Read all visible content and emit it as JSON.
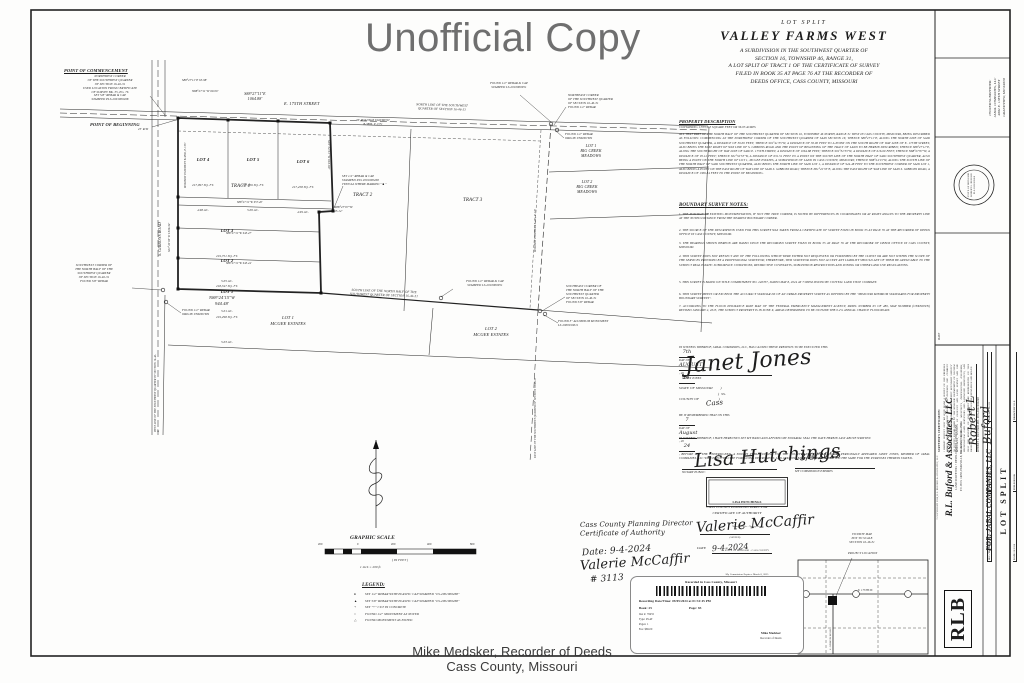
{
  "watermark": "Unofficial Copy",
  "footer": {
    "recorder": "Mike Medsker, Recorder of Deeds",
    "county": "Cass County, Missouri"
  },
  "title": {
    "kicker": "LOT  SPLIT",
    "name": "VALLEY  FARMS  WEST",
    "lines": "A  SUBDIVISION  IN  THE  SOUTHWEST  QUARTER  OF\nSECTION  16,  TOWNSHIP  46,  RANGE  31,\nA  LOT  SPLIT  OF  TRACT  1  OF  THE  CERTIFICATE  OF  SURVEY\nFILED  IN  BOOK  35  AT  PAGE  76  AT  THE  RECORDER  OF\nDEEDS  OFFICE,  CASS  COUNTY,  MISSOURI"
  },
  "description": {
    "heading": "PROPERTY  DESCRIPTION",
    "containing": "CONTAINING 1,553,113 SQUARE FEET OR 36.05 ACRES",
    "body": "ALL THAT PART OF THE NORTH HALF OF THE SOUTHWEST QUARTER OF SECTION 16, TOWNSHIP 46 NORTH, RANGE 31 WEST IN CASS COUNTY, MISSOURI, BEING DESCRIBED AS FOLLOWS: COMMENCING AT THE NORTHWEST CORNER OF THE SOUTHWEST QUARTER OF SAID SECTION 16; THENCE S88°27'11\"E, ALONG THE NORTH LINE OF SAID SOUTHWEST QUARTER, A DISTANCE OF 30.00 FEET; THENCE S01°41'35\"W, A DISTANCE OF 30.00 FEET TO A POINT ON THE SOUTH RIGHT OF WAY LINE OF E. 175TH STREET, ALSO BEING THE EAST RIGHT OF WAY LINE OF S. GIBBONS ROAD AND THE POINT OF BEGINNING OF THE TRACT OF LAND TO BE HEREIN DESCRIBED; THENCE S88°27'11\"E, ALONG THE SOUTH RIGHT OF WAY LINE OF SAID E. 175TH STREET, A DISTANCE OF 1064.88 FEET; THENCE S01°32'53\"W, A DISTANCE OF 616.60 FEET; THENCE N88°27'07\"W, A DISTANCE OF 95.12 FEET; THENCE S01°32'53\"W, A DISTANCE OF 631.51 FEET TO A POINT ON THE SOUTH LINE OF THE NORTH HALF OF SAID SOUTHWEST QUARTER, ALSO BEING A POINT ON THE NORTH LINE OF LOT 1, MCGEE ESTATES, A SUBDIVISION OF LAND IN CASS COUNTY, MISSOURI; THENCE N88°24'15\"W, ALONG THE SOUTH LINE OF THE NORTH HALF OF SAID SOUTHWEST QUARTER, ALSO BEING THE NORTH LINE OF SAID LOT 1, A DISTANCE OF 944.48 FEET TO THE SOUTHWEST CORNER OF SAID LOT 1, ALSO BEING A POINT ON THE EAST RIGHT OF WAY LINE OF SAID S. GIBBONS ROAD; THENCE N01°41'35\"E, ALONG THE EAST RIGHT OF WAY LINE OF SAID S. GIBBONS ROAD, A DISTANCE OF 1306.34 FEET TO THE POINT OF BEGINNING."
  },
  "notes": {
    "heading": "BOUNDARY  SURVEY  NOTES:",
    "items": [
      "1.   THE POSITION OF EXISTING MONUMENTATION, IF NOT THE TRUE CORNER, IS NOTED BY DIFFERENCES IN COORDINATES OR AT RIGHT ANGLES TO THE PROPERTY LINE AT THE NOTED DISTANCE FROM THE NEAREST BOUNDARY CORNER.",
      "2.   THE SOURCE OF THE DESCRIPTION USED FOR THIS SURVEY WAS TAKEN FROM A CERTIFICATE OF SURVEY FILED IN BOOK 35 AT PAGE 76 AT THE RECORDER OF DEEDS OFFICE IN CASS COUNTY, MISSOURI.",
      "3.   THE BEARINGS SHOWN HEREON ARE BASED UPON THE RECORDED SURVEY FILED IN BOOK 35 AT PAGE 76 AT THE RECORDER OF DEEDS OFFICE IN CASS COUNTY, MISSOURI.",
      "4.   THIS SURVEY DOES NOT REFLECT ANY OF THE FOLLOWING WHICH WERE EITHER NOT REQUESTED OR FURNISHED BY THE CLIENT OR ARE NOT WITHIN THE SCOPE OF THE SERVICES PROVIDED BY A PROFESSIONAL SURVEYOR; THEREFORE, THIS SURVEYOR DOES NOT ACCEPT ANY LIABILITY SHOULD ANY OF THEM BE APPLICABLE TO THE SUBJECT REAL ESTATE: SUBSURFACE CONDITIONS, RESTRICTIVE COVENANTS, SUBDIVISION RESTRICTIONS AND ZONING OR OTHER LAND USE REGULATIONS.",
      "5.   THIS SURVEY IS BASED ON TITLE COMMITMENT NO. 240707, DATED MAY 8, 2024 AT 7:00PM ISSUED BY COTTELL LAND TITLE COMPANY.",
      "6.   THIS SURVEY MEETS OR EXCEEDS THE ACCURACY STANDAR DS OF AN URBAN PROPERTY SURVEY AS DEFINED BY THE \"MISSOURI MINIMUM STANDARDS FOR PROPERTY BOUNDARY SURVEYS\".",
      "7.   ACCORDING TO THE FLOOD INSURANCE RATE MAP OF THE FEDERAL EMERGENCY MANAGEMENT AGENCY, PANEL NUMBER 65 OF 480, MAP NUMBER (UNKNOWN) REVISED JANUARY 2, 2013, THE SUBJECT PROPERTY IS IN ZONE X, AREAS DETERMINED TO BE OUTSIDE THE 0.2% ANNUAL CHANCE FLOODPLAIN."
    ]
  },
  "execution": {
    "pre": "IN WITNESS WHEREOF, JABAL COMPANIES, LLC, HAS CAUSED THESE PRESENTS TO BE EXECUTED THIS",
    "day": "7th",
    "mid": "DAY OF",
    "month": "AUGUST",
    "end": ", 20",
    "year": "24.",
    "sig": "Janet Jones",
    "name": "JANET JONES"
  },
  "state_block": {
    "lines": "STATE OF MISSOURI        )\n                                        )  SS.\nCOUNTY OF                    )",
    "county": "Cass"
  },
  "ack": {
    "pre": "BE IT REMEMBERED THAT ON THIS",
    "day": "7",
    "mid": "DAY OF",
    "month": "August",
    "mid2": ", 20",
    "year": "24",
    "post": ", BEFORE ME, THE UNDERSIGNED, A NOTARY PUBLIC IN AND FOR THE COUNTY AND STATE AFORESAID, PERSONALLY APPEARED JANET JONES, MEMBER OF JABAL COMPANIES, LLC WHO EXECUTED THE FOREGOING INSTRUMENT, AND ACKNOWLEDGED THAT SHE EXECUTED THE SAME FOR THE PURPOSES THEREIN STATED.",
    "witness2": "IN WITNESS WHEREOF, I HAVE HEREUNTO SET MY HAND AND AFFIXED MY NOTARIAL SEAL THE DATE HEREIN LAST ABOVE WRITTEN.",
    "notary_sig": "Lisa Hutchings",
    "notary_label": "NOTARY PUBLIC"
  },
  "notary_stamp": {
    "name": "LISA HUTCHINGS",
    "l2": "Notary Public - Notary Seal",
    "l3": "STATE OF MISSOURI - CASS COUNTY",
    "l4": "My Commission Expires: March 8, 2025",
    "l5": "Commission #12380786"
  },
  "commission": {
    "date": "3/8/2025",
    "label": "MY COMMISSION EXPIRES"
  },
  "planning_cert": {
    "h1": "CASS  COUNTY  PLANNING  DIRECTOR",
    "h2": "CERTIFICATE  OF  AUTHORITY",
    "sig": "Valerie McCaffir",
    "signed": "(SIGNED)",
    "date_label": "DATE",
    "date": "9-4-2024"
  },
  "planning_note": {
    "line1": "Cass County Planning Director",
    "line2": "Certificate of Authority",
    "date": "Date:  9-4-2024",
    "sig": "Valerie McCaffir",
    "num": "# 3113"
  },
  "recording": {
    "header": "Recorded in Cass County, Missouri",
    "datetime": "Recording Date/Time: 09/05/2024 at 01:31:45 PM",
    "book_line": "Book:  25",
    "page_line": "Page:  83",
    "rows": [
      "Inst #:  78455",
      "Type:  PLAT",
      "Pages:  1",
      "Fee:  $69.00"
    ],
    "seal_name": "Mike Medsker",
    "seal_title": "Recorder of Deeds"
  },
  "vicinity": {
    "title": "VICINITY MAP\nNOT TO SCALE\nSECTION 16-46-31",
    "project": "PROJECT LOCATION",
    "street_h": "E. 175TH ST.",
    "street_v": "S. GIBBONS ROAD"
  },
  "strip": {
    "owner": "OWNER/SUBDIVIDER:\nJABAL COMPANIES, LLC\n4002 E. 138TH STREET\nGRANDVIEW, MO 64030",
    "seal_text": "STATE OF MISSOURI\nROBERT L. BUFORD\nPLS-2001000268",
    "cert_heading": "SURVEYOR'S  CERTIFICATION:",
    "cert_body": "I HEREBY CERTIFY THAT WE HAVE MADE A SURVEY OF THE PREMISES HEREIN DESCRIBED WHICH MEETS OR EXCEEDS THE CURRENT \"MISSOURI MINIMUM STANDARDS FOR PROPERTY BOUNDARY SURVEYS\" AS JOINTLY ESTABLISHED BY THE MISSOURI DEPARTMENT OF NATURAL RESOURCES, DIVISION OF GEOLOGY AND LAND SURVEY AND THE MISSOURI BOARD FOR ARCHITECTS, PROFESSIONAL ENGINEERS, PROFESSIONAL LAND SURVEYORS AND LANDSCAPE ARCHITECTS, AND THAT THE RESULTS OF SAID SURVEY ARE REPRESENTED ON THIS DRAWING TO THE BEST OF MY PROFESSIONAL KNOWLEDGE AND BELIEF.",
    "cert_sig": "Robert L Buford",
    "cert_name": "ROBERT L. BUFORD   MO. PLS-2001000268",
    "cert_date": "DATE",
    "logo": "RLB",
    "company_name": "R.L. Buford & Associates, LLC",
    "company_tag": "LAND SURVEYING  •  DEVELOPMENT CONSULTANT",
    "company_addr": "P.O. BOX 14058, PARKVILLE, MO. 64152      (816) 741-4732",
    "fields": [
      {
        "label": "SEC./TWP./RGE.",
        "value": "16-46-31"
      },
      {
        "label": "COUNTY",
        "value": "CASS"
      },
      {
        "label": "JOB NO.",
        "value": "24-193"
      },
      {
        "label": "DATE",
        "value": "08/2024"
      },
      {
        "label": "FIELD BOOK",
        "value": ""
      },
      {
        "label": "DRAWN BY",
        "value": "RLB"
      }
    ],
    "for_label": "FOR:   JABAL COMPANIES, LLC",
    "sheet_type": "LOT  SPLIT",
    "copyright": "© COPYRIGHT 2024,  R.L. BUFORD & ASSOCIATES, LLC"
  },
  "plat": {
    "poc_title": "POINT OF COMMENCEMENT",
    "poc_body": "NORTHWEST CORNER\nOF THE SOUTHWEST QUARTER\nOF SECTION 16-46-31\nUSED LOCATION FROM CERTIFICATE\nOF SURVEY BK. 35, PG. 76\nSET 5/8\" REBAR & CAP\nSTAMPED PLS-2001000268",
    "pob": "POINT OF BEGINNING",
    "dim_a": "S88°27'11\"E  65.98'",
    "dim_b": "N88°27'11\"W  60.00'",
    "rw25": "25' R/W",
    "street": "E. 175TH STREET",
    "dim_street": "S88°27'11\"E\n1064.88'",
    "north_line": "NORTH LINE OF THE SOUTHWEST\nQUARTER OF SECTION 16-46-31",
    "found_cap_ne": "FOUND 1/2\" REBAR & CAP\nSTAMPED LS-2010000951",
    "ne_corner": "NORTHEAST CORNER\nOF THE SOUTHWEST QUARTER\nOF SECTION 16-46-31\nFOUND 1/2\" REBAR",
    "found_unknown_ne": "FOUND 1/2\" REBAR\nORIGIN UNKNOWN",
    "bcm1": "LOT 1\nBIG CREEK\nMEADOWS",
    "bcm2": "LOT 2\nBIG CREEK\nMEADOWS",
    "esmt_top": "30' ROADWAY EASEMENT\nB-3886, P-1371",
    "esmt_left": "ROADWAY EASEMENT B-3886, P-1371",
    "esmt_right": "ROADWAY EASEMENT E-295, P-128",
    "lots": [
      {
        "name": "LOT 4",
        "sqft": "217,097 SQ. FT.",
        "ac": "4.98 AC."
      },
      {
        "name": "LOT 5",
        "sqft": "217,656 SQ. FT.",
        "ac": "5.00 AC."
      },
      {
        "name": "LOT 6",
        "sqft": "217,458 SQ. FT.",
        "ac": "4.99 AC."
      },
      {
        "name": "LOT 3",
        "sqft": "219,751 SQ. FT.",
        "ac": "5.05 AC."
      },
      {
        "name": "LOT 2",
        "sqft": "218,347 SQ. FT.",
        "ac": "5.01 AC."
      },
      {
        "name": "LOT 1",
        "sqft": "219,298 SQ. FT.",
        "ac": "5.03 AC."
      }
    ],
    "tract1": "TRACT  1",
    "tract2": "TRACT  2",
    "tract3": "TRACT  3",
    "dim_tract": "S88°27'11\"W   957.40'",
    "dim_32": "S88°27'11\"W   943.47'",
    "dim_21": "S88°27'11\"W   943.44'",
    "dim_bottom": "N88°24'15\"W\n944.48'",
    "dim_east": "S01°32'53\"W   616.60'",
    "jog": "N88°27'07\"W\n95.12'",
    "set_note": "SET 1/2\" REBAR & CAP\nSTAMPED PLS 2001000268\nTYPICAL WHERE MARKED \" ■ \"",
    "gibbons": "S. GIBBONS ROAD",
    "dim_west": "S01°41'35\"W   1306.34'",
    "west_line": "WEST LINE OF THE SOUTHWEST QUARTER OF SECTION 16-46-31",
    "east_line": "EAST LINE OF THE SOUTHWEST QUARTER OF SECTION 16-46-31",
    "sw_corner": "SOUTHWEST CORNER OF\nTHE NORTH HALF OF THE\nSOUTHWEST QUARTER\nOF SECTION 16-46-31\nFOUND 5/8\" REBAR",
    "found_unknown_sw": "FOUND 1/2\" REBAR\nORIGIN UNKNOWN",
    "south_line": "SOUTH LINE OF THE NORTH HALF OF THE\nSOUTHWEST QUARTER OF SECTION 16-46-31",
    "found_cap_s": "FOUND 1/2\" REBAR & CAP\nSTAMPED LS-2010000951",
    "se_corner": "SOUTHEAST CORNER OF\nTHE NORTH HALF OF THE\nSOUTHWEST QUARTER\nOF SECTION 16-46-31\nFOUND 5/8\" REBAR",
    "found_alum": "FOUND 3\" ALUMINUM MONUMENT\nLS-2000019011",
    "mcgee1": "LOT 1\nMCGEE ESTATES",
    "mcgee2": "LOT 2\nMCGEE ESTATES",
    "scale_title": "GRAPHIC  SCALE",
    "scale_ticks": [
      "200",
      "0",
      "200",
      "400",
      "800"
    ],
    "scale_feet": "( IN FEET )",
    "scale_inch": "1 inch = 200 ft.",
    "legend_title": "LEGEND:",
    "legend": [
      {
        "s": "●",
        "t": "SET 1/2\" REBAR WITH PLASTIC CAP STAMPED \"LS-2001000268\""
      },
      {
        "s": "▲",
        "t": "SET 5/8\" REBAR WITH PLASTIC CAP STAMPED \"LS-2001000268\""
      },
      {
        "s": "+",
        "t": "SET \"+\" CUT IN CONCRETE"
      },
      {
        "s": "○",
        "t": "FOUND 1/2\" MONUMENT AS NOTED"
      },
      {
        "s": "△",
        "t": "FOUND MONUMENT AS NOTED"
      }
    ]
  }
}
